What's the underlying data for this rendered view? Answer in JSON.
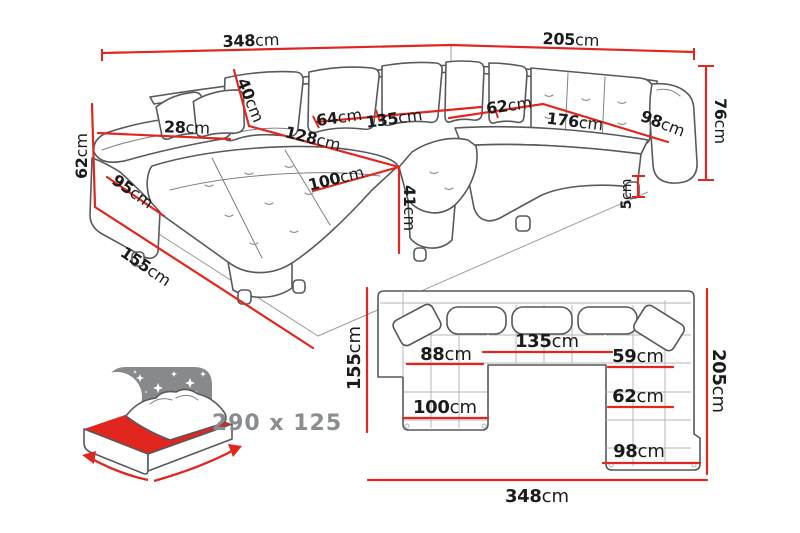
{
  "colors": {
    "dimension_red": "#e0261f",
    "line_gray": "#57595c",
    "icon_gray": "#87898b",
    "text_black": "#1b1b1b",
    "text_gray": "#8a8d8f"
  },
  "perspective_view": {
    "labels": [
      {
        "name": "dim-back-left-348",
        "num": "348",
        "unit": "cm",
        "x": 251,
        "y": 40,
        "rot": -2,
        "size": 16
      },
      {
        "name": "dim-back-right-205",
        "num": "205",
        "unit": "cm",
        "x": 571,
        "y": 39,
        "rot": 2,
        "size": 16
      },
      {
        "name": "dim-height-76",
        "num": "76",
        "unit": "cm",
        "x": 721,
        "y": 121,
        "rot": 90,
        "size": 16
      },
      {
        "name": "dim-height-62",
        "num": "62",
        "unit": "cm",
        "x": 81,
        "y": 156,
        "rot": -90,
        "size": 16
      },
      {
        "name": "dim-armrest-95",
        "num": "95",
        "unit": "cm",
        "x": 133,
        "y": 191,
        "rot": 35,
        "size": 16
      },
      {
        "name": "dim-chaise-155",
        "num": "155",
        "unit": "cm",
        "x": 146,
        "y": 266,
        "rot": 34,
        "size": 16
      },
      {
        "name": "dim-armrest-28",
        "num": "28",
        "unit": "cm",
        "x": 187,
        "y": 127,
        "rot": 2,
        "size": 16
      },
      {
        "name": "dim-cushion-40",
        "num": "40",
        "unit": "cm",
        "x": 251,
        "y": 100,
        "rot": 68,
        "size": 16
      },
      {
        "name": "dim-seat-64",
        "num": "64",
        "unit": "cm",
        "x": 339,
        "y": 117,
        "rot": -8,
        "size": 16
      },
      {
        "name": "dim-seat-135",
        "num": "135",
        "unit": "cm",
        "x": 394,
        "y": 118,
        "rot": -8,
        "size": 16
      },
      {
        "name": "dim-chaise-inner-128",
        "num": "128",
        "unit": "cm",
        "x": 313,
        "y": 138,
        "rot": 14,
        "size": 16
      },
      {
        "name": "dim-chaise-width-100",
        "num": "100",
        "unit": "cm",
        "x": 336,
        "y": 178,
        "rot": -14,
        "size": 16
      },
      {
        "name": "dim-seat-height-41",
        "num": "41",
        "unit": "cm",
        "x": 410,
        "y": 208,
        "rot": 90,
        "size": 16
      },
      {
        "name": "dim-corner-62",
        "num": "62",
        "unit": "cm",
        "x": 509,
        "y": 105,
        "rot": -8,
        "size": 16
      },
      {
        "name": "dim-bench-176",
        "num": "176",
        "unit": "cm",
        "x": 575,
        "y": 121,
        "rot": 7,
        "size": 16
      },
      {
        "name": "dim-bench-98",
        "num": "98",
        "unit": "cm",
        "x": 663,
        "y": 123,
        "rot": 21,
        "size": 16
      },
      {
        "name": "dim-leg-5",
        "num": "5",
        "unit": "cm",
        "x": 627,
        "y": 194,
        "rot": -90,
        "size": 14
      }
    ]
  },
  "plan_view": {
    "labels": [
      {
        "name": "plan-dim-155",
        "num": "155",
        "unit": "cm",
        "x": 354,
        "y": 358,
        "rot": -90,
        "size": 18
      },
      {
        "name": "plan-dim-205",
        "num": "205",
        "unit": "cm",
        "x": 719,
        "y": 381,
        "rot": 90,
        "size": 18
      },
      {
        "name": "plan-dim-348",
        "num": "348",
        "unit": "cm",
        "x": 537,
        "y": 496,
        "rot": 0,
        "size": 18
      },
      {
        "name": "plan-dim-135",
        "num": "135",
        "unit": "cm",
        "x": 547,
        "y": 341,
        "rot": 0,
        "size": 18
      },
      {
        "name": "plan-dim-88",
        "num": "88",
        "unit": "cm",
        "x": 446,
        "y": 354,
        "rot": 0,
        "size": 18
      },
      {
        "name": "plan-dim-59",
        "num": "59",
        "unit": "cm",
        "x": 638,
        "y": 356,
        "rot": 0,
        "size": 18
      },
      {
        "name": "plan-dim-100",
        "num": "100",
        "unit": "cm",
        "x": 445,
        "y": 407,
        "rot": 0,
        "size": 18
      },
      {
        "name": "plan-dim-62",
        "num": "62",
        "unit": "cm",
        "x": 638,
        "y": 396,
        "rot": 0,
        "size": 18
      },
      {
        "name": "plan-dim-98",
        "num": "98",
        "unit": "cm",
        "x": 639,
        "y": 451,
        "rot": 0,
        "size": 18
      }
    ]
  },
  "sleep_function": {
    "dimensions": "290 x 125"
  }
}
